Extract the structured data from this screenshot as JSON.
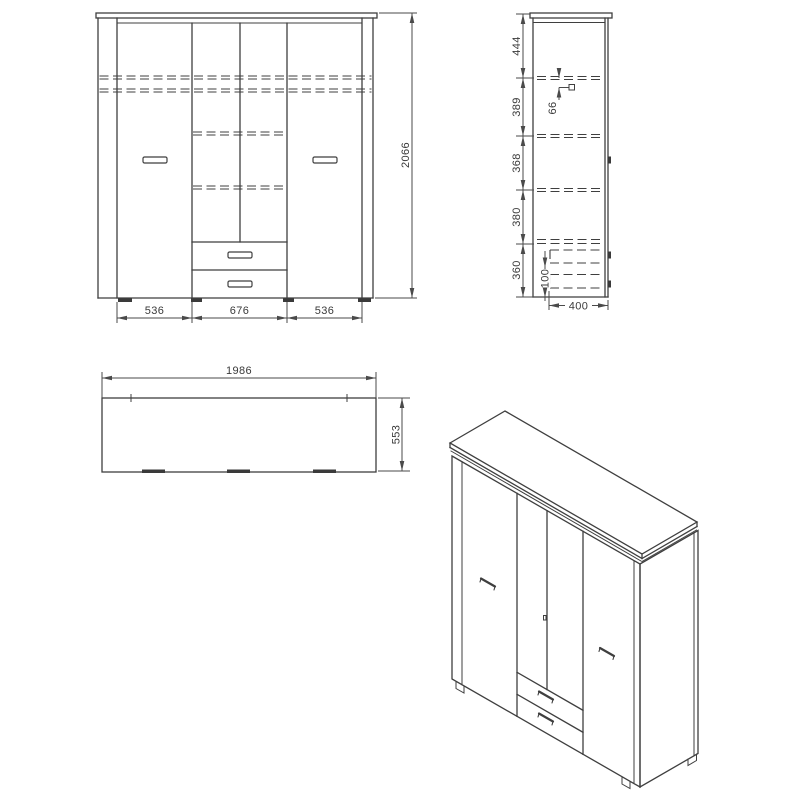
{
  "views": {
    "front": {
      "dims": {
        "left": "536",
        "center": "676",
        "right": "536",
        "height": "2066"
      }
    },
    "side": {
      "dims": {
        "s1": "444",
        "s2": "389",
        "s3": "368",
        "s4": "380",
        "s5": "360",
        "rail": "66",
        "plinth": "100",
        "depth": "400"
      }
    },
    "top": {
      "dims": {
        "width": "1986",
        "depth": "553"
      }
    }
  },
  "colors": {
    "line": "#3f3f3f",
    "dim": "#4a4a4a",
    "text": "#3a3a3a",
    "background": "#ffffff"
  }
}
